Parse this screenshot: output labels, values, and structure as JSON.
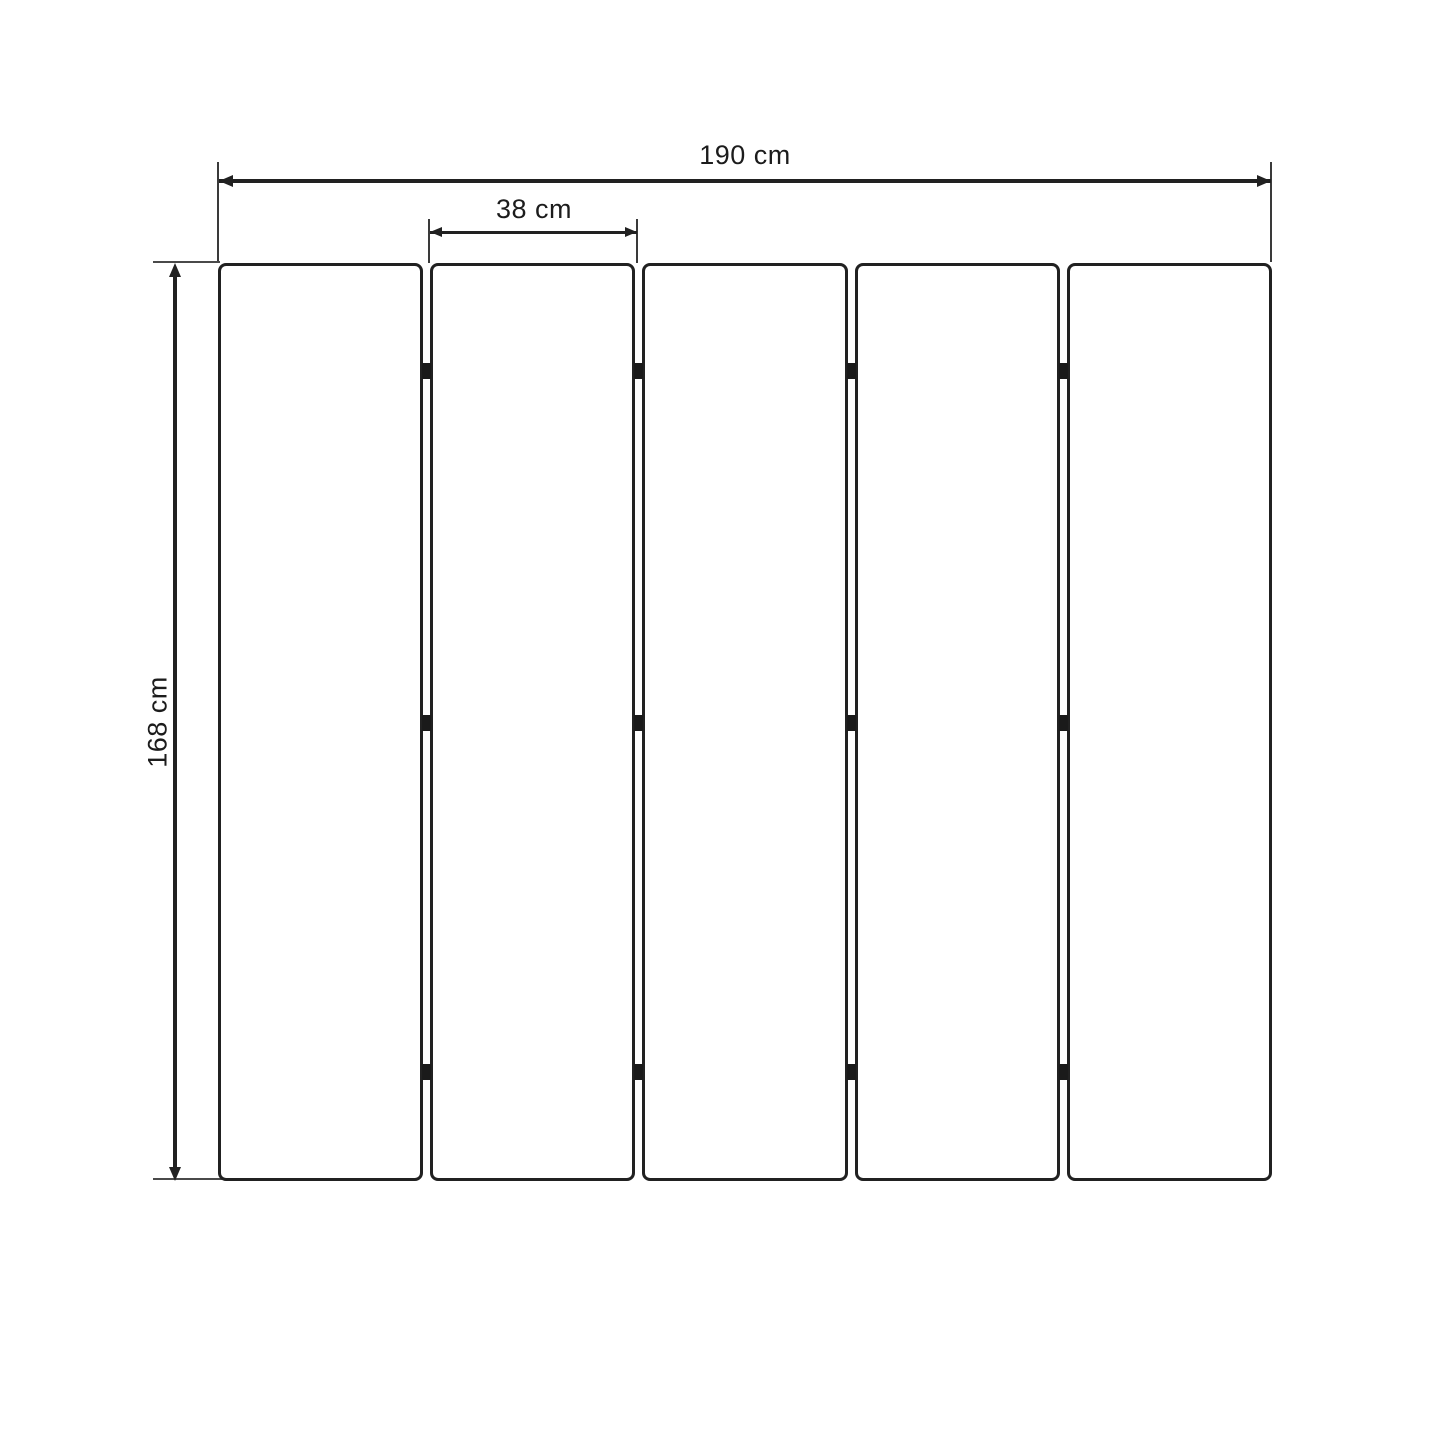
{
  "diagram": {
    "type": "dimension-diagram",
    "labels": {
      "total_width": "190 cm",
      "panel_width": "38 cm",
      "height": "168 cm"
    },
    "panel_count": 5,
    "hinge_rows_per_gap": 3,
    "colors": {
      "line": "#212121",
      "hinge": "#1a1a1a",
      "text": "#1c1c1c",
      "background": "#ffffff"
    }
  }
}
